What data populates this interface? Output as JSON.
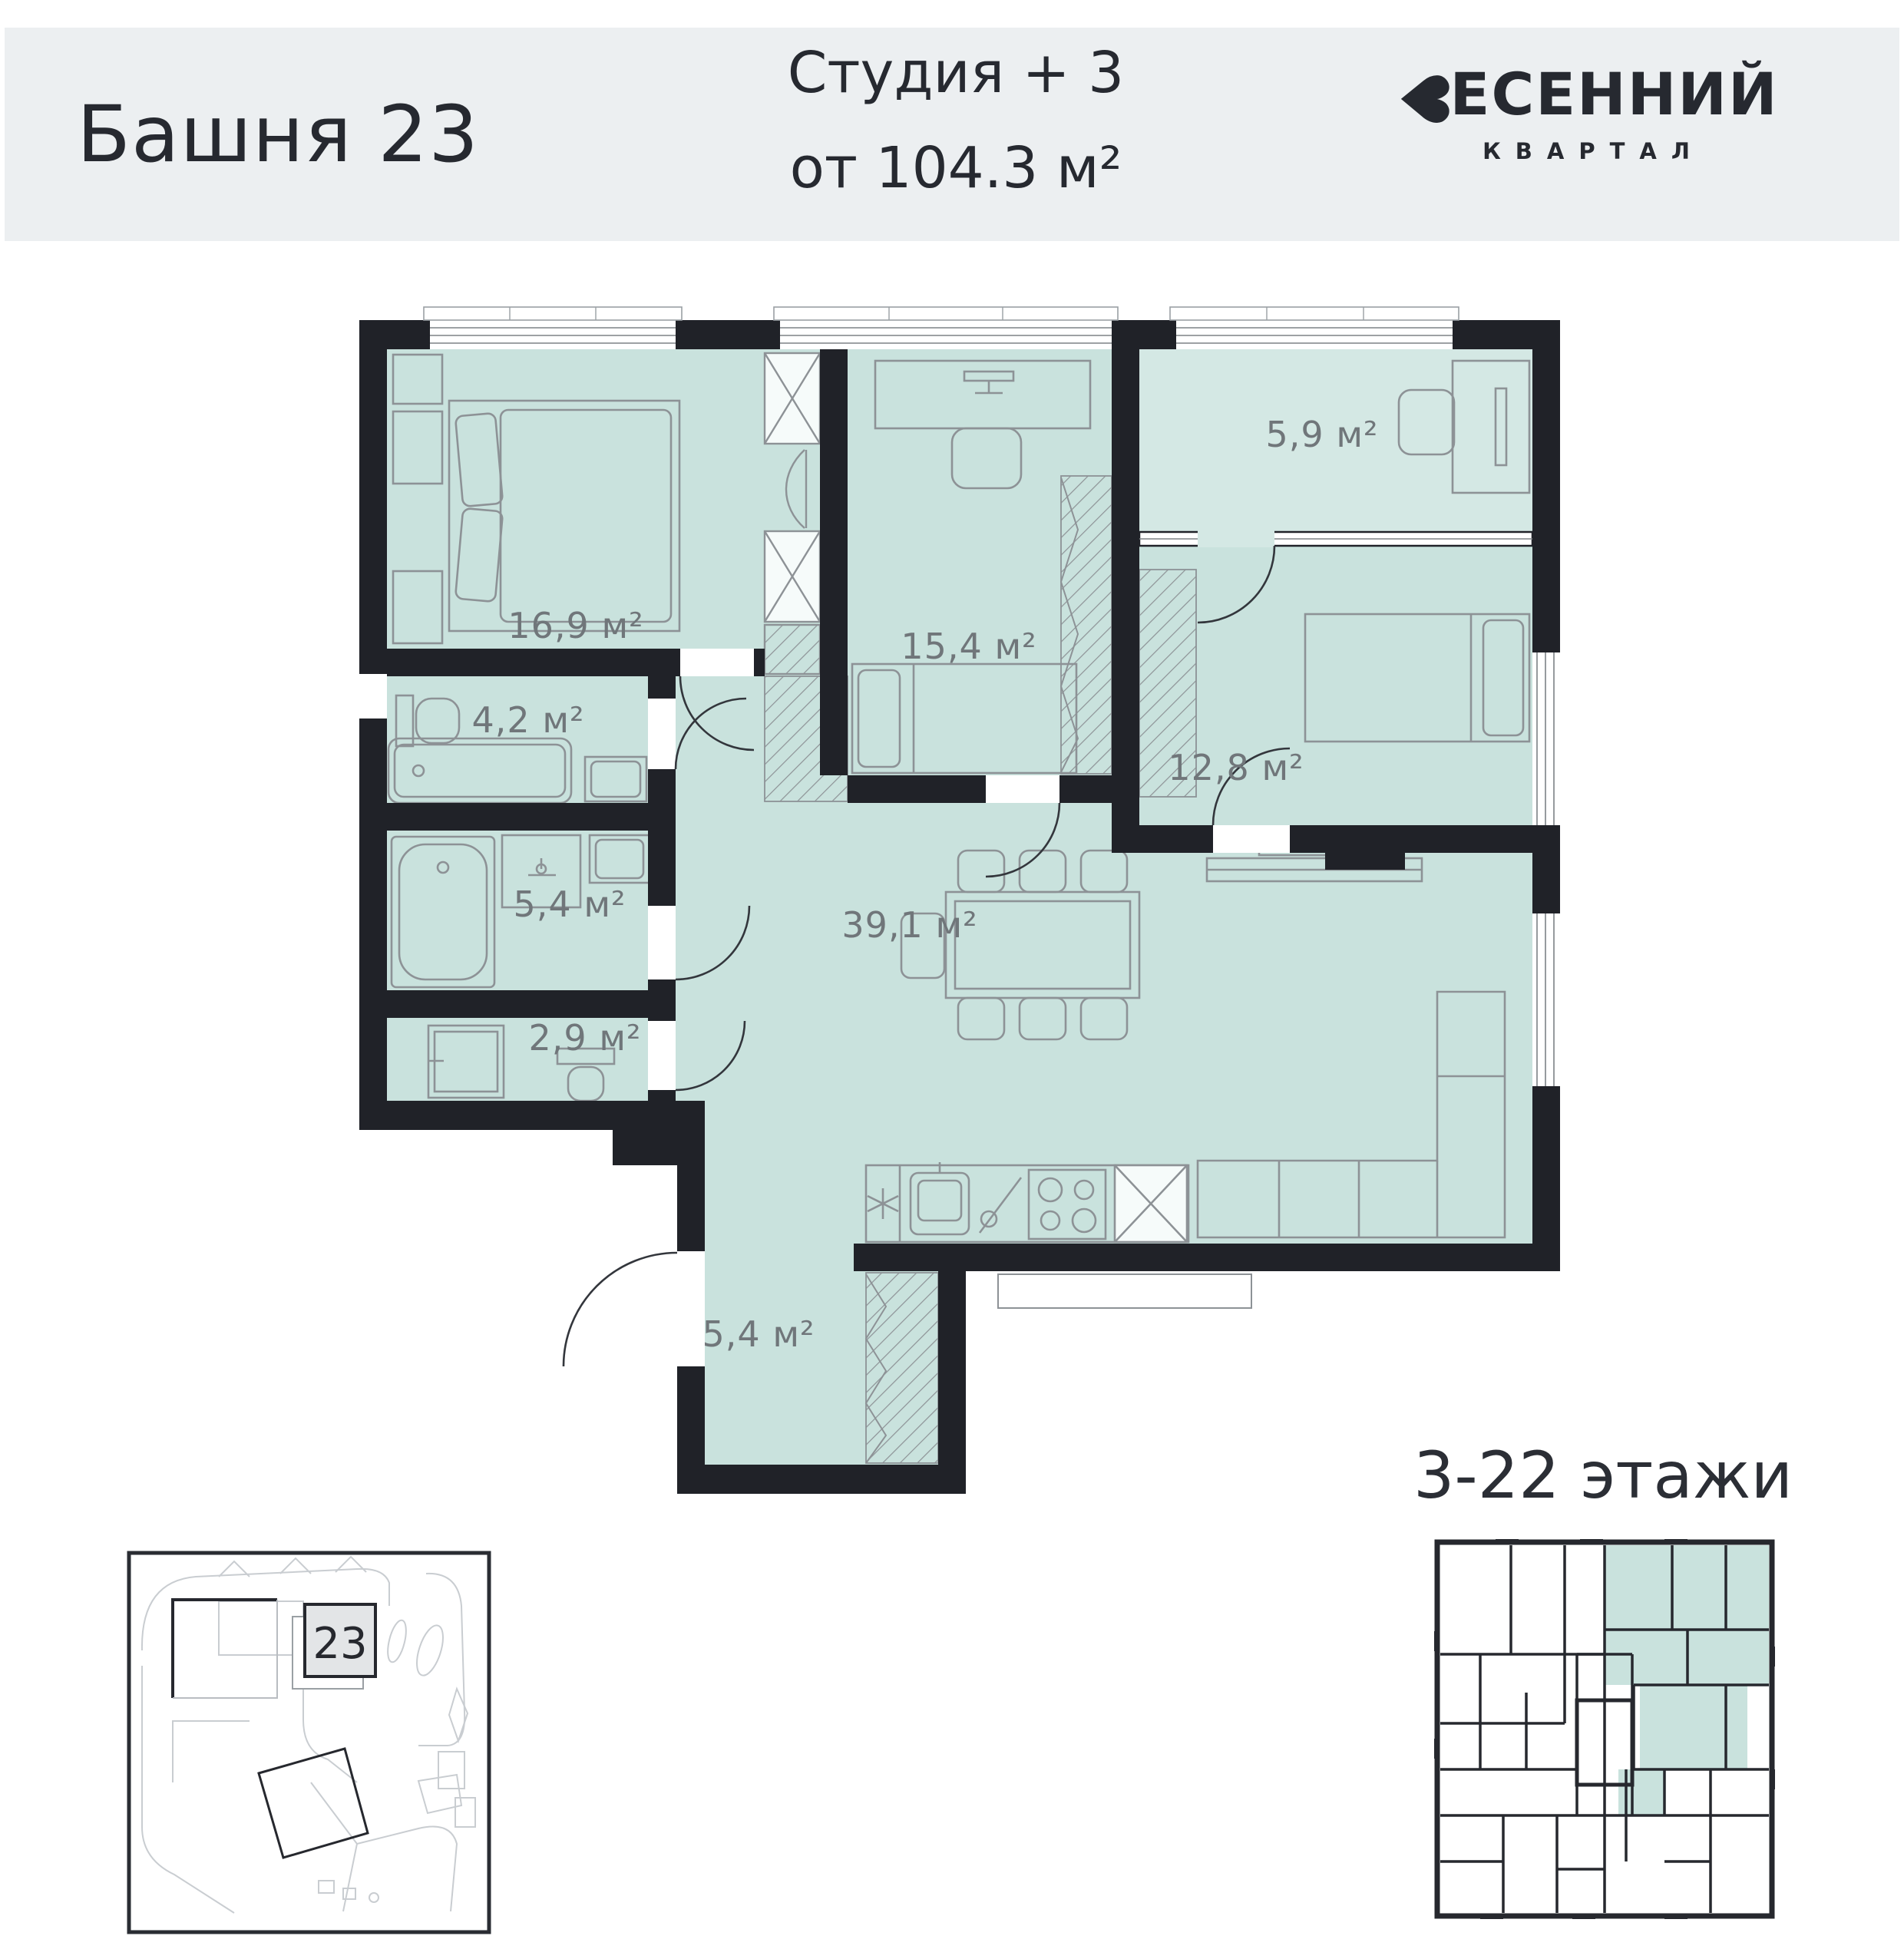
{
  "header": {
    "tower": "Башня 23",
    "unit_type": "Студия + 3",
    "area_from": "от 104.3 м²",
    "logo": {
      "name": "ВЕСЕННИЙ",
      "name_rest": "ЕСЕННИЙ",
      "heart_glyph": "♥",
      "subtitle": "КВАРТАЛ"
    }
  },
  "plan": {
    "rooms": [
      {
        "id": "bedroom-1",
        "area": "16,9 м²"
      },
      {
        "id": "bathroom-1",
        "area": "4,2 м²"
      },
      {
        "id": "bedroom-2",
        "area": "15,4 м²"
      },
      {
        "id": "loggia",
        "area": "5,9 м²"
      },
      {
        "id": "bedroom-3",
        "area": "12,8 м²"
      },
      {
        "id": "bathroom-2",
        "area": "5,4 м²"
      },
      {
        "id": "living-kitchen",
        "area": "39,1 м²"
      },
      {
        "id": "wc",
        "area": "2,9 м²"
      },
      {
        "id": "hallway",
        "area": "5,4 м²"
      }
    ]
  },
  "site_plan": {
    "building_number": "23"
  },
  "floors_label": "3-22 этажи",
  "colors": {
    "header_bg": "#eceff1",
    "text_dark": "#262930",
    "room_fill": "#c9e2dd",
    "loggia_fill": "#d4e8e4",
    "wall": "#202228",
    "area_label_text": "#70767a",
    "furniture_stroke": "#8d9296"
  }
}
